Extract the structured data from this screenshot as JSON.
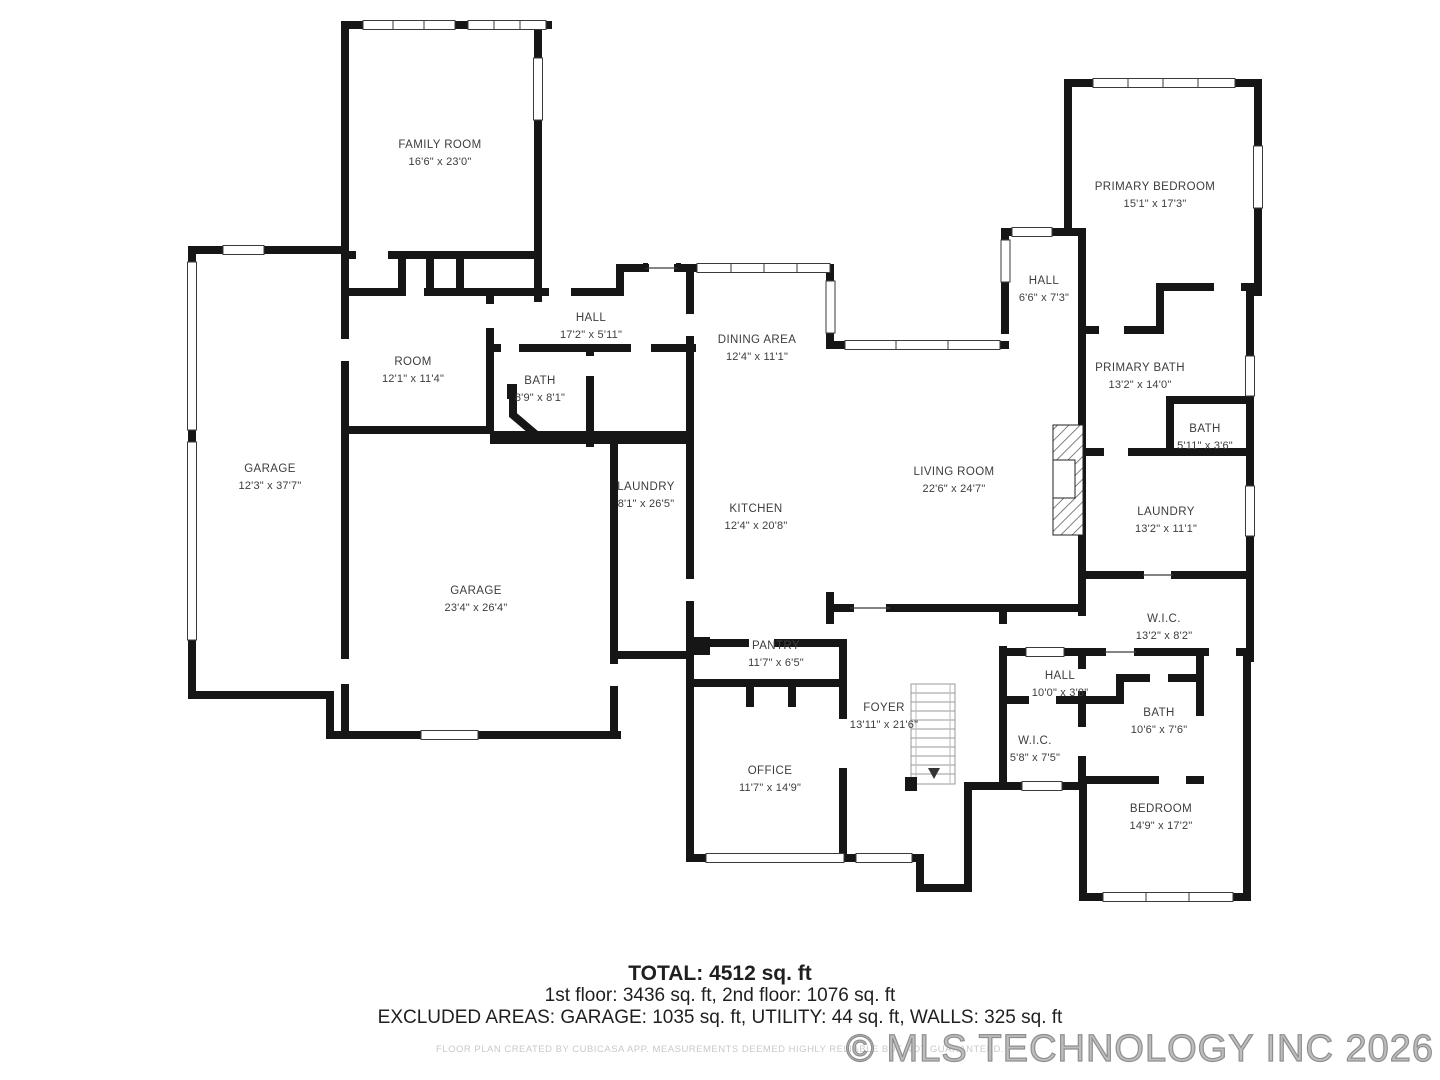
{
  "rooms": [
    {
      "name": "FAMILY ROOM",
      "dims": "16'6\" x 23'0\""
    },
    {
      "name": "ROOM",
      "dims": "12'1\" x 11'4\""
    },
    {
      "name": "HALL",
      "dims": "17'2\" x 5'11\""
    },
    {
      "name": "BATH",
      "dims": "8'9\" x 8'1\""
    },
    {
      "name": "GARAGE",
      "dims": "12'3\" x 37'7\""
    },
    {
      "name": "GARAGE",
      "dims": "23'4\" x 26'4\""
    },
    {
      "name": "LAUNDRY",
      "dims": "8'1\" x 26'5\""
    },
    {
      "name": "DINING AREA",
      "dims": "12'4\" x 11'1\""
    },
    {
      "name": "KITCHEN",
      "dims": "12'4\" x 20'8\""
    },
    {
      "name": "LIVING ROOM",
      "dims": "22'6\" x 24'7\""
    },
    {
      "name": "HALL",
      "dims": "6'6\" x 7'3\""
    },
    {
      "name": "PRIMARY BEDROOM",
      "dims": "15'1\" x 17'3\""
    },
    {
      "name": "PRIMARY BATH",
      "dims": "13'2\" x 14'0\""
    },
    {
      "name": "BATH",
      "dims": "5'11\" x 3'6\""
    },
    {
      "name": "LAUNDRY",
      "dims": "13'2\" x 11'1\""
    },
    {
      "name": "W.I.C.",
      "dims": "13'2\" x 8'2\""
    },
    {
      "name": "HALL",
      "dims": "10'0\" x 3'8\""
    },
    {
      "name": "BATH",
      "dims": "10'6\" x 7'6\""
    },
    {
      "name": "W.I.C.",
      "dims": "5'8\" x 7'5\""
    },
    {
      "name": "FOYER",
      "dims": "13'11\" x 21'6\""
    },
    {
      "name": "PANTRY",
      "dims": "11'7\" x 6'5\""
    },
    {
      "name": "OFFICE",
      "dims": "11'7\" x 14'9\""
    },
    {
      "name": "BEDROOM",
      "dims": "14'9\" x 17'2\""
    }
  ],
  "footer": {
    "total": "TOTAL: 4512 sq. ft",
    "floors": "1st floor: 3436 sq. ft, 2nd floor: 1076 sq. ft",
    "excluded": "EXCLUDED AREAS: GARAGE: 1035 sq. ft, UTILITY: 44 sq. ft, WALLS: 325 sq. ft",
    "disclaimer": "FLOOR PLAN CREATED BY CUBICASA APP. MEASUREMENTS DEEMED HIGHLY RELIABLE BUT NOT GUARANTEED."
  },
  "watermark": "© MLS TECHNOLOGY INC 2026"
}
